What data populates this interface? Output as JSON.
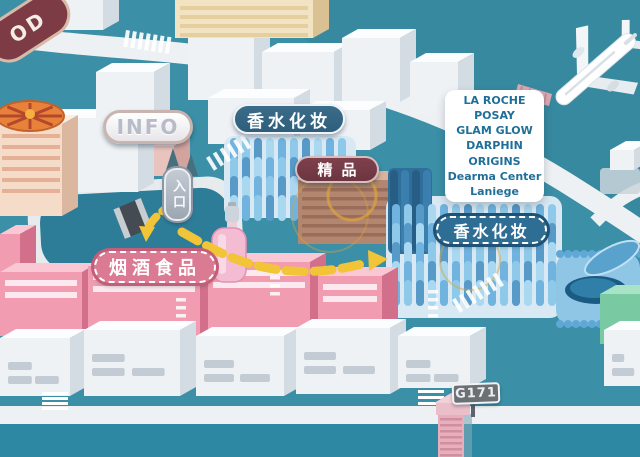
{
  "signs": {
    "corner_partial": {
      "label": "OD"
    },
    "info": {
      "label": "INFO"
    },
    "entrance": {
      "label": "入口"
    },
    "perfume_cosmetics_upper": {
      "label": "香水化妆"
    },
    "boutique": {
      "label": "精品"
    },
    "tobacco_liquor_food": {
      "label": "烟酒食品"
    },
    "perfume_cosmetics_lower": {
      "label": "香水化妆"
    },
    "gate": {
      "label": "G171"
    }
  },
  "brand_card": {
    "lines": [
      "LA ROCHE",
      "POSAY",
      "GLAM GLOW",
      "DARPHIN",
      "ORIGINS",
      "Dearma Center",
      "Laniege"
    ]
  },
  "colors": {
    "bg_teal": "#3B8FA7",
    "water": "#2D89A3",
    "road_white": "#EDF1F3",
    "route_yellow": "#F2C437",
    "sign_pink": "#DB7A93",
    "sign_blue_dark": "#2E5E7B",
    "sign_blue": "#2F6E94",
    "sign_maroon": "#6C3540",
    "card_text": "#1F6F99",
    "gate_sign_gray": "#6B7075",
    "building_pink": "#F19CB0",
    "building_blue": "#6FB3DE"
  }
}
